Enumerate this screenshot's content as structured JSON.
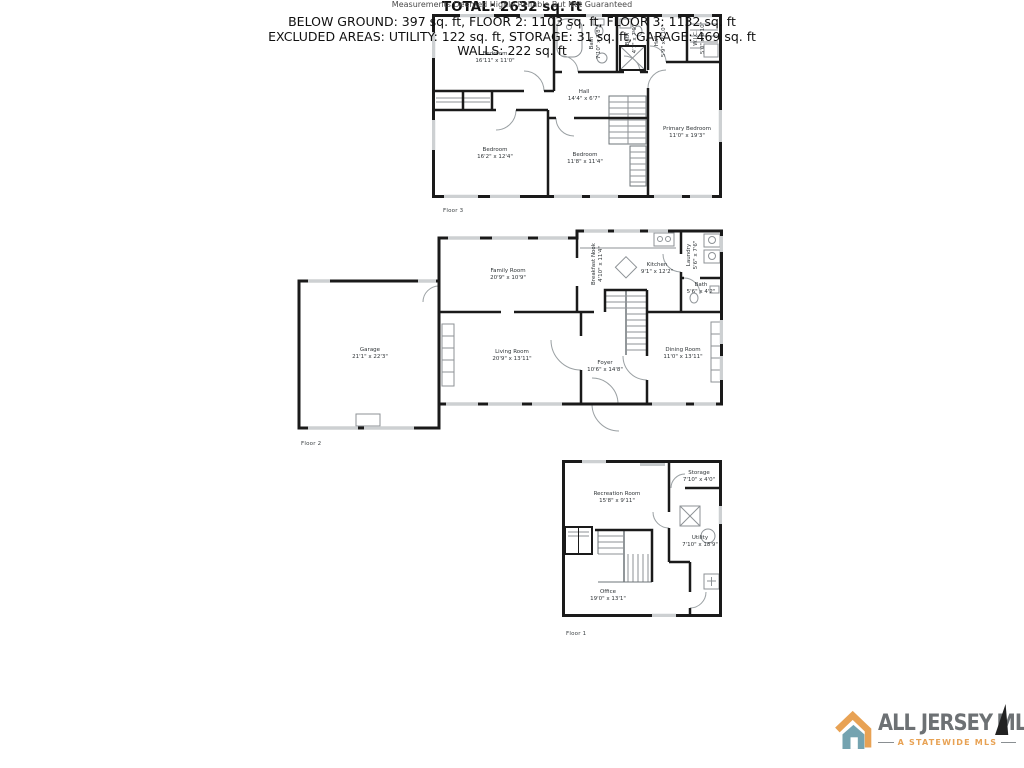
{
  "floors": [
    {
      "label": "Floor 3",
      "rooms": [
        {
          "name": "Bedroom",
          "dims": "16'11\" x 11'0\""
        },
        {
          "name": "Bath",
          "dims": "7'10\" x 7'8\""
        },
        {
          "name": "Bath",
          "dims": "4'7\" x 7'9\""
        },
        {
          "name": "Hall",
          "dims": "5'9\" x 6'10\""
        },
        {
          "name": "W.I.C.",
          "dims": "5'0\" x 6'10\""
        },
        {
          "name": "Hall",
          "dims": "14'4\" x 6'7\""
        },
        {
          "name": "Primary Bedroom",
          "dims": "11'0\" x 19'3\""
        },
        {
          "name": "Bedroom",
          "dims": "16'2\" x 12'4\""
        },
        {
          "name": "Bedroom",
          "dims": "11'8\" x 11'4\""
        }
      ]
    },
    {
      "label": "Floor 2",
      "rooms": [
        {
          "name": "Garage",
          "dims": "21'1\" x 22'3\""
        },
        {
          "name": "Family Room",
          "dims": "20'9\" x 10'9\""
        },
        {
          "name": "Breakfast Nook",
          "dims": "4'10\" x 11'4\""
        },
        {
          "name": "Kitchen",
          "dims": "9'1\" x 12'2\""
        },
        {
          "name": "Laundry",
          "dims": "5'6\" x 7'6\""
        },
        {
          "name": "Bath",
          "dims": "5'6\" x 4'2\""
        },
        {
          "name": "Living Room",
          "dims": "20'9\" x 13'11\""
        },
        {
          "name": "Foyer",
          "dims": "10'6\" x 14'8\""
        },
        {
          "name": "Dining Room",
          "dims": "11'0\" x 13'11\""
        }
      ]
    },
    {
      "label": "Floor 1",
      "rooms": [
        {
          "name": "Recreation Room",
          "dims": "15'8\" x 9'11\""
        },
        {
          "name": "Storage",
          "dims": "7'10\" x 4'0\""
        },
        {
          "name": "Utility",
          "dims": "7'10\" x 18'9\""
        },
        {
          "name": "Office",
          "dims": "19'0\" x 13'1\""
        }
      ]
    }
  ],
  "summary": {
    "total": "TOTAL: 2632 sq. ft",
    "line1": "BELOW GROUND: 397 sq. ft, FLOOR 2: 1103 sq. ft, FLOOR 3: 1132 sq. ft",
    "line2": "EXCLUDED AREAS: UTILITY: 122 sq. ft, STORAGE: 31 sq. ft, GARAGE: 469 sq. ft",
    "line3": "WALLS: 222 sq. ft",
    "disclaimer": "Measurements Deemed Highly Reliable But Not Guaranteed"
  },
  "logo": {
    "title1": "ALL JERSEY",
    "title2": "MLS",
    "subtitle": "A STATEWIDE MLS",
    "colors": {
      "text_gray": "#6d7174",
      "orange": "#e8a254",
      "teal": "#74a3b0",
      "wall": "#1a1a1a",
      "window": "#cdd0d2",
      "fixture": "#8d9296"
    }
  }
}
